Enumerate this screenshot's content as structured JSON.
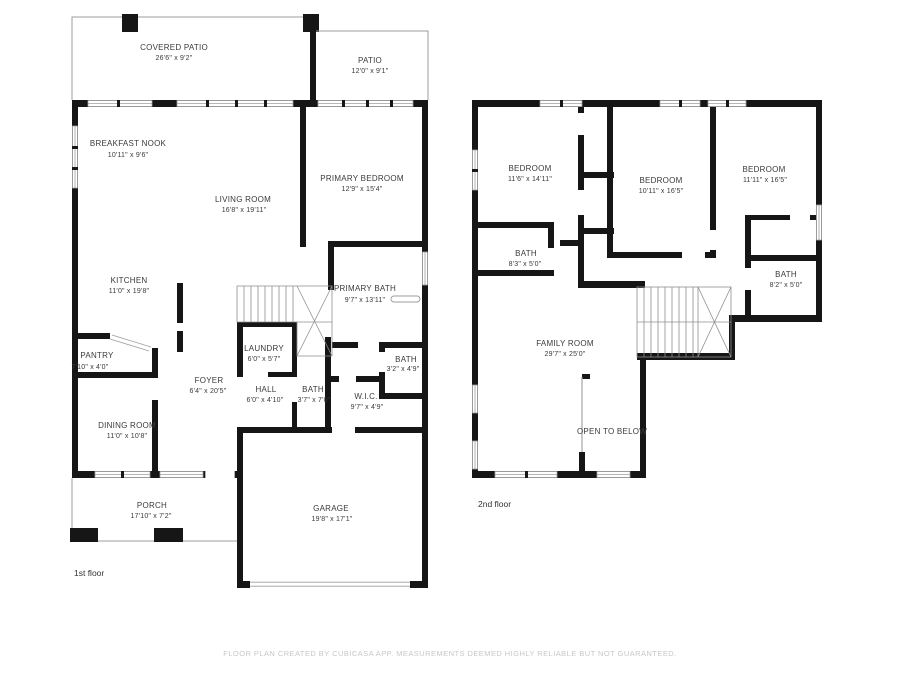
{
  "colors": {
    "wall": "#161616",
    "thin_line": "#9e9e9e",
    "label_text": "#3a3a3a",
    "footer_text": "#c7c7c7",
    "background": "#ffffff"
  },
  "floor1": {
    "label": "1st floor",
    "rooms": {
      "covered_patio": {
        "name": "COVERED PATIO",
        "dims": "26'6\" x 9'2\""
      },
      "patio": {
        "name": "PATIO",
        "dims": "12'0\" x 9'1\""
      },
      "breakfast_nook": {
        "name": "BREAKFAST NOOK",
        "dims": "10'11\" x 9'6\""
      },
      "living_room": {
        "name": "LIVING ROOM",
        "dims": "16'8\" x 19'11\""
      },
      "primary_bedroom": {
        "name": "PRIMARY BEDROOM",
        "dims": "12'9\" x 15'4\""
      },
      "kitchen": {
        "name": "KITCHEN",
        "dims": "11'0\" x 19'8\""
      },
      "primary_bath": {
        "name": "PRIMARY BATH",
        "dims": "9'7\" x 13'11\""
      },
      "pantry": {
        "name": "PANTRY",
        "dims": "7'10\" x 4'0\""
      },
      "laundry": {
        "name": "LAUNDRY",
        "dims": "6'0\" x 5'7\""
      },
      "foyer": {
        "name": "FOYER",
        "dims": "6'4\" x 20'5\""
      },
      "hall": {
        "name": "HALL",
        "dims": "6'0\" x 4'10\""
      },
      "bath": {
        "name": "BATH",
        "dims": "3'7\" x 7'0\""
      },
      "wic": {
        "name": "W.I.C.",
        "dims": "9'7\" x 4'9\""
      },
      "small_bath": {
        "name": "BATH",
        "dims": "3'2\" x 4'9\""
      },
      "dining_room": {
        "name": "DINING ROOM",
        "dims": "11'0\" x 10'8\""
      },
      "porch": {
        "name": "PORCH",
        "dims": "17'10\" x 7'2\""
      },
      "garage": {
        "name": "GARAGE",
        "dims": "19'8\" x 17'1\""
      }
    }
  },
  "floor2": {
    "label": "2nd floor",
    "rooms": {
      "bedroom_left": {
        "name": "BEDROOM",
        "dims": "11'6\" x 14'11\""
      },
      "bedroom_mid": {
        "name": "BEDROOM",
        "dims": "10'11\" x 16'5\""
      },
      "bedroom_right": {
        "name": "BEDROOM",
        "dims": "11'11\" x 16'5\""
      },
      "bath_left": {
        "name": "BATH",
        "dims": "8'3\" x 5'0\""
      },
      "bath_right": {
        "name": "BATH",
        "dims": "8'2\" x 5'0\""
      },
      "family_room": {
        "name": "FAMILY ROOM",
        "dims": "29'7\" x 25'0\""
      },
      "open_to_below": {
        "name": "OPEN TO BELOW"
      }
    }
  },
  "footer": "FLOOR PLAN CREATED BY CUBICASA APP. MEASUREMENTS DEEMED HIGHLY RELIABLE BUT NOT GUARANTEED."
}
